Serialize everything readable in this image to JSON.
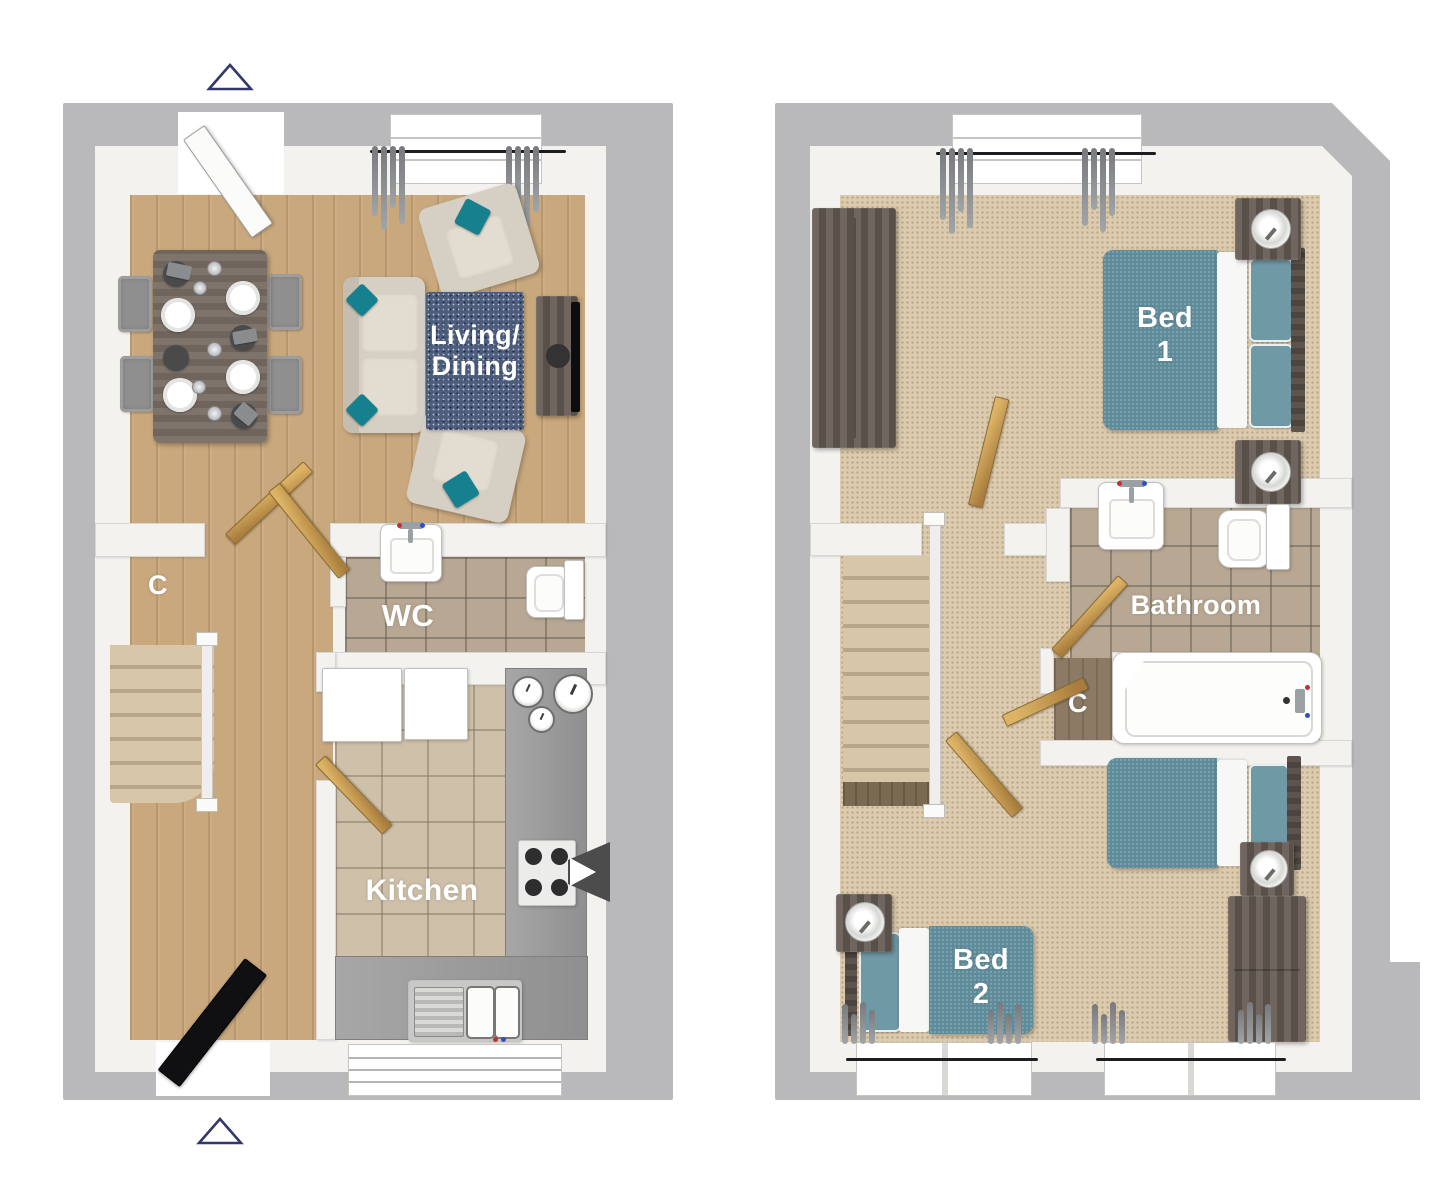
{
  "document": {
    "type": "3d-floor-plan",
    "floors_count": 2
  },
  "colors": {
    "wall_outer": "#b9b9bb",
    "wall_inner_face": "#f3f2ef",
    "wood_floor": "#c9a87d",
    "carpet": "#dccbae",
    "tile": "#b8a893",
    "kitchen_tile": "#cfc0a9",
    "accent_teal": "#17808f",
    "bed_teal": "#5e8c9a",
    "rug_navy": "#4c5d7d",
    "door_wood": "#c69a52",
    "counter_gray": "#9e9e9e",
    "dark_furniture": "#6b615a",
    "marker_outline": "#33376b",
    "label_text": "#ffffff"
  },
  "floors": [
    {
      "name": "ground",
      "rooms": [
        {
          "id": "living-dining",
          "name": "Living/Dining",
          "label_lines": [
            "Living/",
            "Dining"
          ],
          "floor": "wood"
        },
        {
          "id": "understairs-cupboard",
          "name": "C",
          "label_lines": [
            "C"
          ],
          "floor": "wood"
        },
        {
          "id": "wc",
          "name": "WC",
          "label_lines": [
            "WC"
          ],
          "floor": "tile"
        },
        {
          "id": "kitchen",
          "name": "Kitchen",
          "label_lines": [
            "Kitchen"
          ],
          "floor": "tile"
        }
      ]
    },
    {
      "name": "first",
      "rooms": [
        {
          "id": "bed-1",
          "name": "Bed 1",
          "label_lines": [
            "Bed",
            "1"
          ],
          "floor": "carpet"
        },
        {
          "id": "bathroom",
          "name": "Bathroom",
          "label_lines": [
            "Bathroom"
          ],
          "floor": "tile"
        },
        {
          "id": "cupboard",
          "name": "C",
          "label_lines": [
            "C"
          ],
          "floor": "wood"
        },
        {
          "id": "bed-2",
          "name": "Bed 2",
          "label_lines": [
            "Bed",
            "2"
          ],
          "floor": "carpet"
        }
      ]
    }
  ],
  "markers": {
    "top_entrance": "triangle-up",
    "bottom_entrance": "triangle-up"
  }
}
